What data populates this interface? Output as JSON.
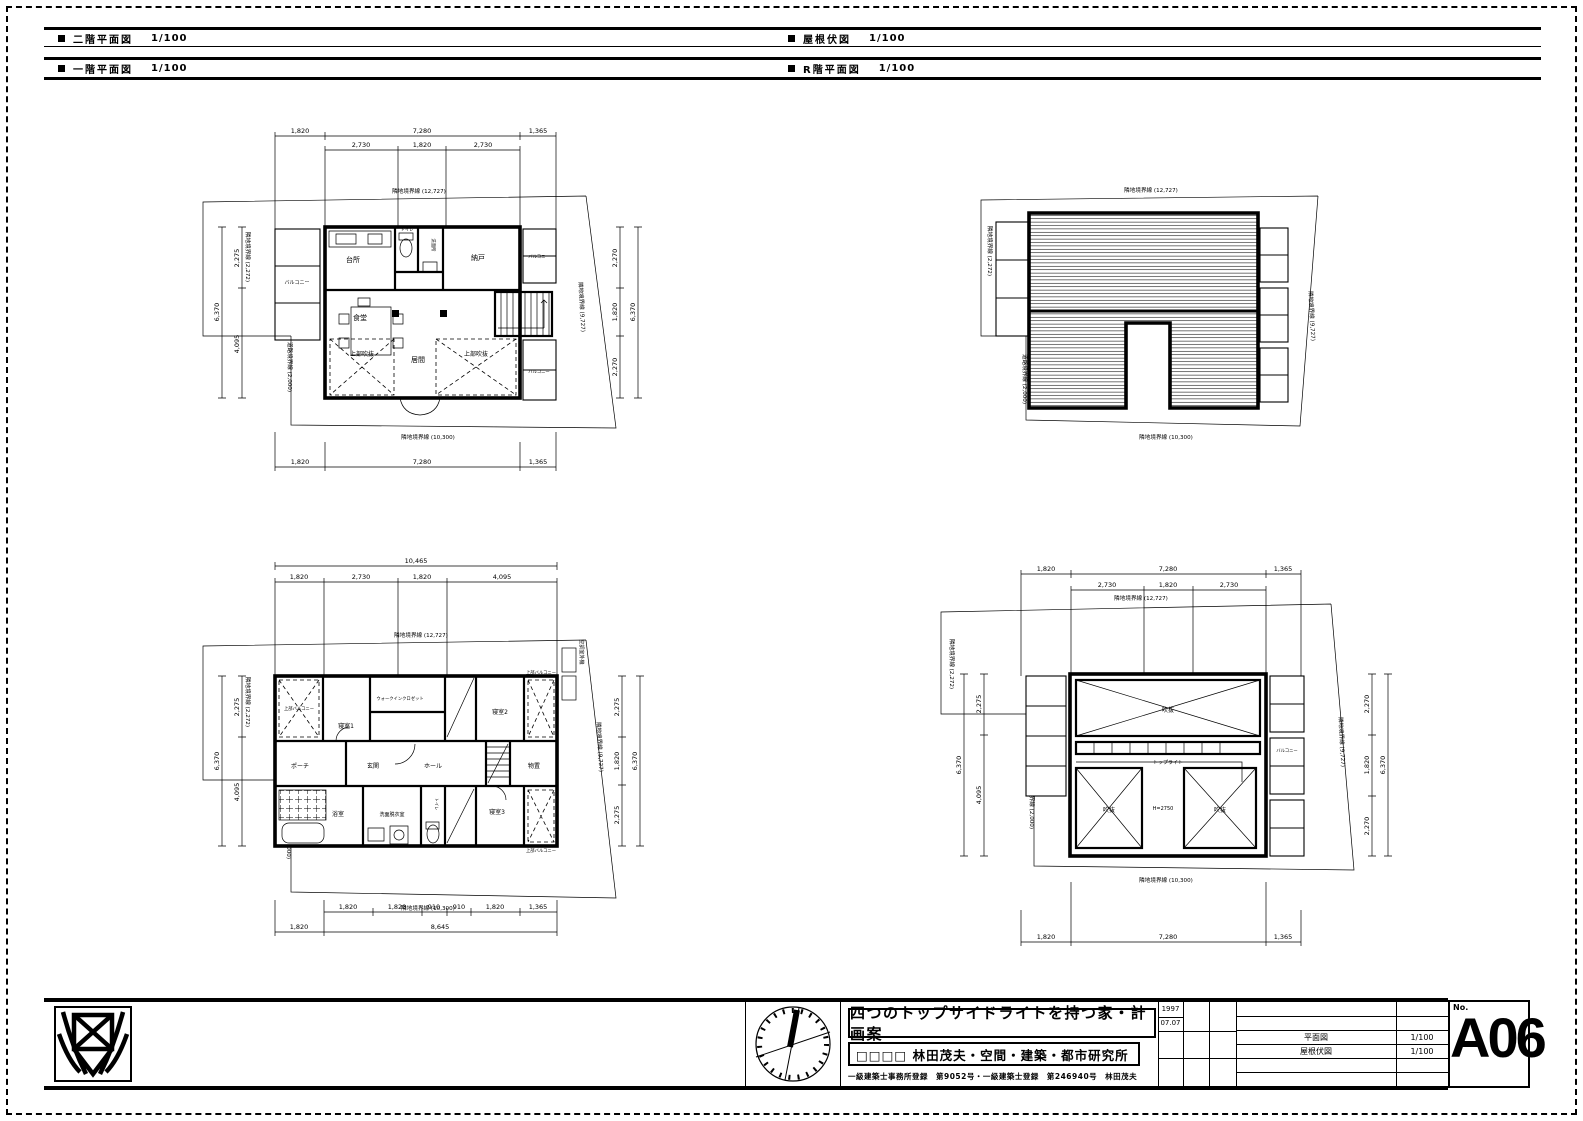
{
  "colors": {
    "line": "#000000",
    "bg": "#ffffff"
  },
  "headers": {
    "f2": {
      "label": "二階平面図",
      "scale": "1/100"
    },
    "roof": {
      "label": "屋根伏図",
      "scale": "1/100"
    },
    "f1": {
      "label": "一階平面図",
      "scale": "1/100"
    },
    "rf": {
      "label": "R階平面図",
      "scale": "1/100"
    }
  },
  "boundary": {
    "top": "隣地境界線 (12,727)",
    "left": "隣地境界線 (2,272)",
    "road": "道路境界線 (2,000)",
    "bottom": "隣地境界線 (10,300)",
    "right": "隣地境界線 (9,727)"
  },
  "plans": {
    "f2": {
      "dims": {
        "top_outer": [
          "1,820",
          "7,280",
          "1,365"
        ],
        "top_inner": [
          "2,730",
          "1,820",
          "2,730"
        ],
        "left_outer": "6,370",
        "left_inner": [
          "2,275",
          "4,095"
        ],
        "right_outer": "6,370",
        "right_inner": [
          "2,270",
          "1,820",
          "2,270"
        ],
        "bottom_outer": [
          "1,820",
          "7,280",
          "1,365"
        ]
      },
      "rooms": {
        "kitchen": "台所",
        "toilet": "トイレ",
        "wash": "洗面所",
        "closet": "納戸",
        "dining": "食堂",
        "living": "居間",
        "void_l": "上部吹抜",
        "void_r": "上部吹抜",
        "balcony_l": "バルコニー",
        "balcony_r1": "バルコニー",
        "balcony_r2": "バルコニー"
      }
    },
    "f1": {
      "dims": {
        "top_total": "10,465",
        "top_inner": [
          "1,820",
          "2,730",
          "1,820",
          "4,095"
        ],
        "left_outer": "6,370",
        "left_inner": [
          "2,275",
          "4,095"
        ],
        "right_outer": "6,370",
        "right_inner": [
          "2,275",
          "1,820",
          "2,275"
        ],
        "bottom_inner": [
          "1,820",
          "1,820",
          "910",
          "910",
          "1,820",
          "1,365"
        ],
        "bottom_outer": [
          "1,820",
          "8,645"
        ]
      },
      "rooms": {
        "balcony_tl": "上部バルコニー",
        "bed1": "寝室1",
        "wic": "ウォークインクロゼット",
        "bed2": "寝室2",
        "balcony_tr": "上部バルコニー",
        "porch": "ポーチ",
        "entry": "玄関",
        "hall": "ホール",
        "storage": "物置",
        "bath": "浴室",
        "wash": "洗面脱衣室",
        "toilet": "トイレ",
        "bed3": "寝室3",
        "balcony_br": "上部バルコニー",
        "ac": "空調室外機"
      }
    },
    "rf": {
      "dims": {
        "top_outer": [
          "1,820",
          "7,280",
          "1,365"
        ],
        "top_inner": [
          "2,730",
          "1,820",
          "2,730"
        ],
        "left_outer": "6,370",
        "left_inner": [
          "2,275",
          "4,095"
        ],
        "right_outer": "6,370",
        "right_inner": [
          "2,270",
          "1,820",
          "2,270"
        ],
        "bottom_outer": [
          "1,820",
          "7,280",
          "1,365"
        ]
      },
      "rooms": {
        "void_top": "吹抜",
        "toplight": "トップライト",
        "void_bl": "吹抜",
        "center": "H=2750",
        "void_br": "吹抜",
        "balcony": "バルコニー"
      }
    }
  },
  "title_block": {
    "title": "四つのトップサイドライトを持つ家・計画案",
    "firm": "□□□□ 林田茂夫・空間・建築・都市研究所",
    "license": "一級建築士事務所登録　第9052号・一級建築士登録　第246940号　林田茂夫",
    "date_year": "1997",
    "date_md": "07.07",
    "drawing_rows": [
      {
        "name": "平面図",
        "scale": "1/100"
      },
      {
        "name": "屋根伏図",
        "scale": "1/100"
      }
    ],
    "no_label": "No.",
    "sheet_no": "A06"
  },
  "icons": {
    "compass": "north-compass",
    "logo": "office-logo",
    "marker": "section-square"
  }
}
